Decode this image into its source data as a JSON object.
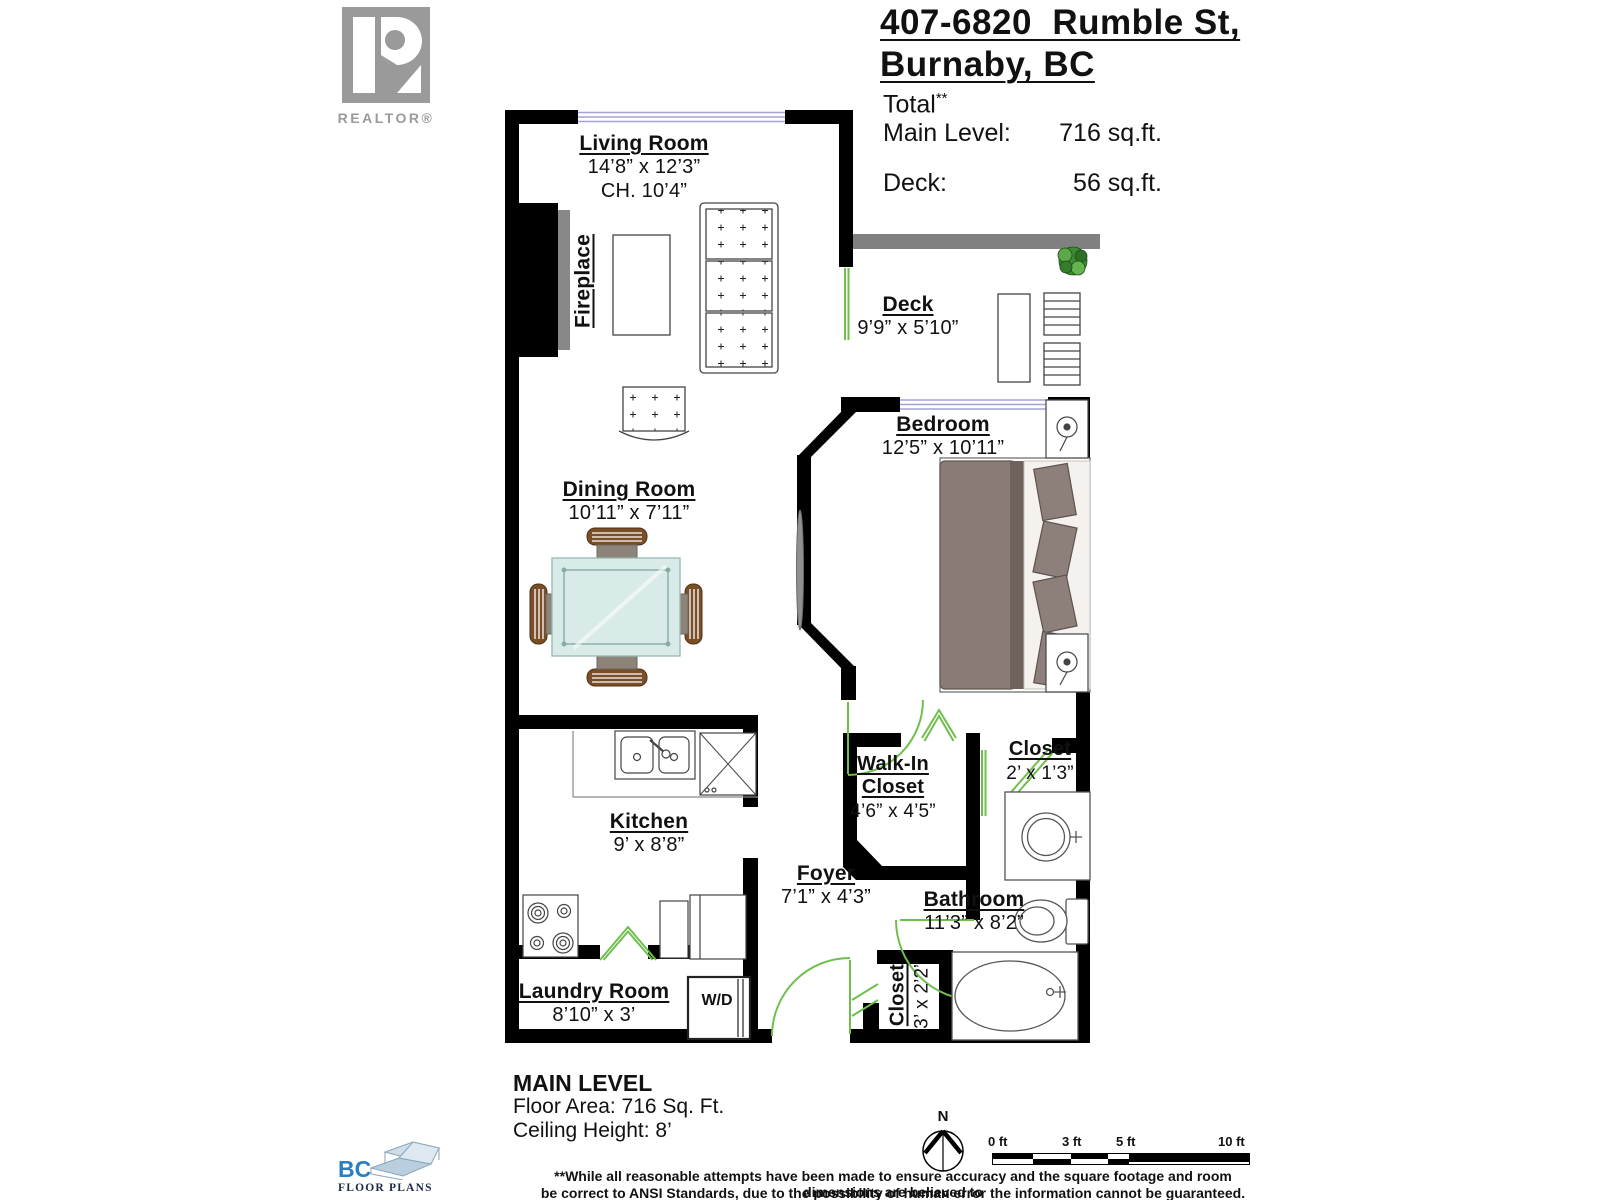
{
  "header": {
    "address_line1": "407-6820  Rumble St,",
    "address_line2": "Burnaby, BC",
    "total_label": "Total",
    "total_sup": "**",
    "main_level_label": "Main Level:",
    "main_level_value": "716 sq.ft.",
    "deck_label": "Deck:",
    "deck_value": "56 sq.ft."
  },
  "logos": {
    "realtor_label": "REALTOR®",
    "bc_text": "BC",
    "bc_label": "FLOOR PLANS"
  },
  "rooms": {
    "living": {
      "name": "Living Room",
      "dims": "14’8” x 12’3”",
      "ch": "CH. 10’4”"
    },
    "deck": {
      "name": "Deck",
      "dims": "9’9” x 5’10”"
    },
    "bedroom": {
      "name": "Bedroom",
      "dims": "12’5” x 10’11”"
    },
    "dining": {
      "name": "Dining Room",
      "dims": "10’11” x 7’11”"
    },
    "kitchen": {
      "name": "Kitchen",
      "dims": "9’ x 8’8”"
    },
    "walkin": {
      "name_line1": "Walk-In",
      "name_line2": "Closet",
      "dims": "4’6” x 4’5”"
    },
    "closet_small": {
      "name": "Closet",
      "dims": "2’ x 1’3”"
    },
    "bathroom": {
      "name": "Bathroom",
      "dims": "11’3” x 8’2”"
    },
    "foyer": {
      "name": "Foyer",
      "dims": "7’1” x 4’3”"
    },
    "laundry": {
      "name": "Laundry Room",
      "dims": "8’10” x 3’"
    },
    "closet_hall": {
      "name": "Closet",
      "dims": "3’ x 2’2”"
    },
    "fireplace_label": "Fireplace",
    "wd_label": "W/D"
  },
  "footer": {
    "level_title": "MAIN LEVEL",
    "floor_area": "Floor Area: 716 Sq. Ft.",
    "ceiling_height": "Ceiling Height: 8’",
    "compass_label": "N",
    "scale_ticks": [
      "0 ft",
      "3 ft",
      "5 ft",
      "10 ft"
    ],
    "disclaimer_line1": "**While all reasonable attempts have been made to ensure accuracy and the square footage and room dimensions are believed to",
    "disclaimer_line2": "be correct to ANSI Standards, due to the possibility of human error the information cannot be guaranteed. E&O Insured for $1,000,000"
  },
  "colors": {
    "wall": "#000000",
    "door_green": "#6fbf4d",
    "window_line": "#a3a3d6",
    "railing_gray": "#808080",
    "bed": "#8a7c75",
    "glass_table": "#d8ebe8",
    "chair_brown": "#7a4e27",
    "logo_gray": "#9a9a9a",
    "bc_blue": "#2a7fc1"
  }
}
